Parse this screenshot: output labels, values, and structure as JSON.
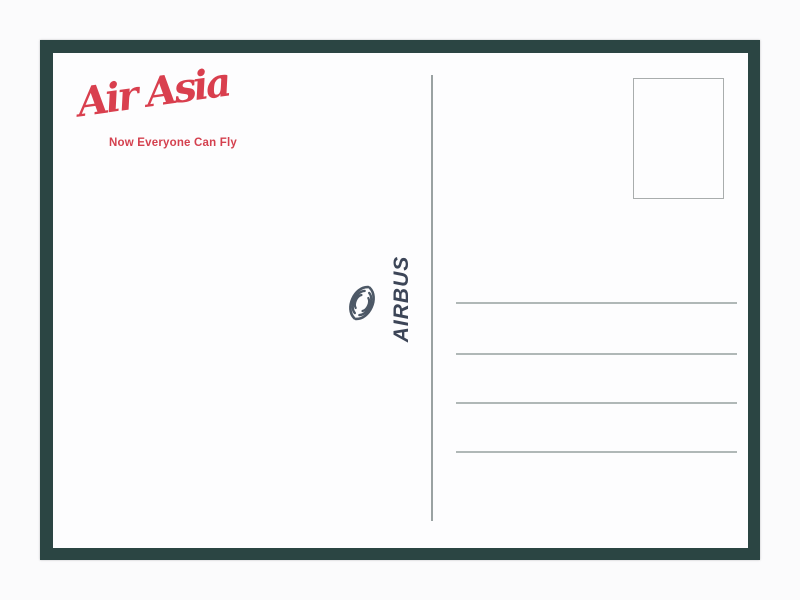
{
  "postcard": {
    "brand": {
      "logo_text": "Air Asia",
      "tagline": "Now Everyone Can Fly",
      "brand_color": "#d93f4e"
    },
    "manufacturer": {
      "label": "AIRBUS",
      "label_color": "#3c4557",
      "icon": "airbus-globe-swirl-icon"
    },
    "layout_colors": {
      "frame_color": "#2b4543",
      "card_color": "#fdfdfe",
      "rule_line_color": "#b0b8b7"
    },
    "address_area": {
      "stamp_box_present": true,
      "line_count": 4
    }
  }
}
